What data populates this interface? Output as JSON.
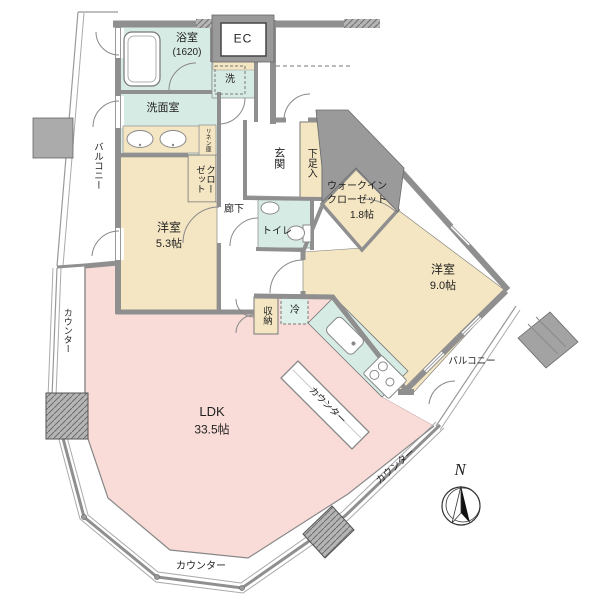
{
  "title": "マンション間取り図",
  "colors": {
    "wet_room": "#d7ebe5",
    "bedroom": "#f4e6c3",
    "ldk": "#f9dcd8",
    "wall": "#8f8f8f",
    "pillar": "#ababab",
    "line": "#777777"
  },
  "rooms": {
    "bath": {
      "label": "浴室",
      "size": "(1620)"
    },
    "ec": {
      "label": "EC"
    },
    "washer": {
      "label": "洗"
    },
    "washroom": {
      "label": "洗面室"
    },
    "linen": {
      "label": "リネン庫"
    },
    "closet": {
      "label": "クローゼット"
    },
    "bedroom1": {
      "label": "洋室",
      "size": "5.3帖"
    },
    "hallway": {
      "label": "廊下"
    },
    "entrance": {
      "label": "玄関"
    },
    "shoe": {
      "label": "下足入"
    },
    "toilet": {
      "label": "トイレ"
    },
    "wic": {
      "line1": "ウォークイン",
      "line2": "クローゼット",
      "size": "1.8帖"
    },
    "bedroom2": {
      "label": "洋室",
      "size": "9.0帖"
    },
    "storage": {
      "label": "収納"
    },
    "fridge": {
      "label": "冷"
    },
    "ldk": {
      "label": "LDK",
      "size": "33.5帖"
    },
    "balcony_left": {
      "label": "バルコニー"
    },
    "balcony_right": {
      "label": "バルコニー"
    },
    "counter_left": {
      "label": "カウンター"
    },
    "counter_bottom": {
      "label": "カウンター"
    },
    "counter_right": {
      "label": "カウンター"
    },
    "counter_island": {
      "label": "カウンター"
    }
  },
  "compass": {
    "label": "N"
  }
}
